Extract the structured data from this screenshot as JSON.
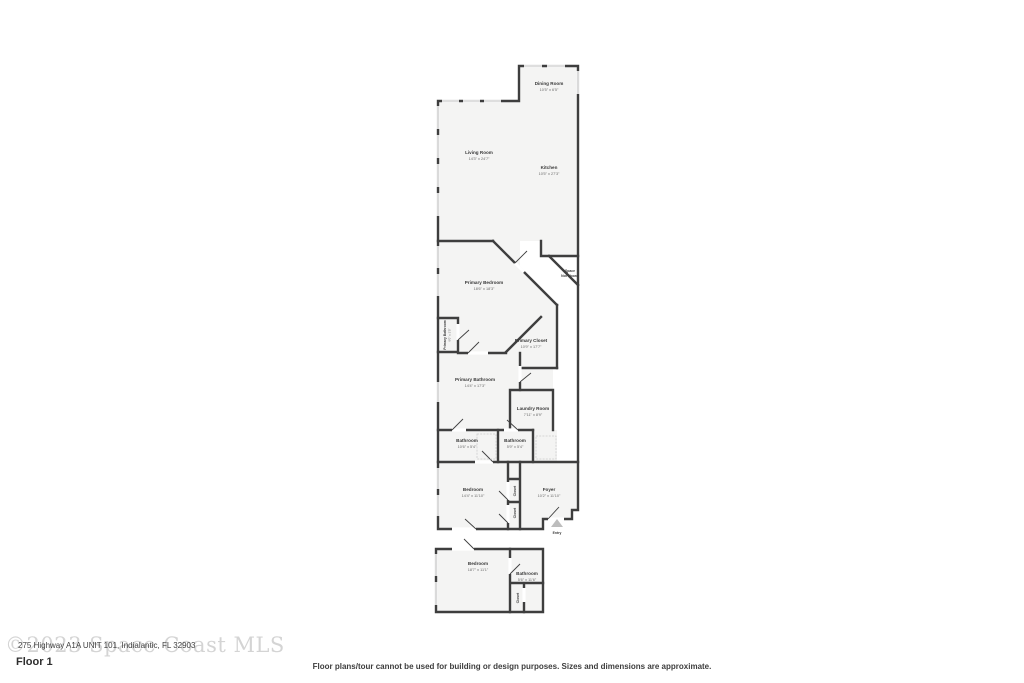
{
  "floor": {
    "label": "Floor 1"
  },
  "watermark": "©2023 Space Coast MLS",
  "address": "275 Highway A1A UNIT 101, Indialantic, FL 32903",
  "disclaimer": "Floor plans/tour cannot be used for building or design purposes. Sizes and dimensions are approximate.",
  "rooms": {
    "dining": {
      "name": "Dining Room",
      "dims": "10'5\" x 6'5\""
    },
    "living": {
      "name": "Living Room",
      "dims": "14'3\" x 24'7\""
    },
    "kitchen": {
      "name": "Kitchen",
      "dims": "10'5\" x 27'3\""
    },
    "space_not_shown": {
      "line1": "Space",
      "line2": "Not Shown"
    },
    "primary_bedroom": {
      "name": "Primary Bedroom",
      "dims": "18'6\" x 18'3\""
    },
    "primary_bath_wc": {
      "name": "Primary Bathroom",
      "dims": "6'0\" x 3'5\""
    },
    "primary_closet": {
      "name": "Primary Closet",
      "dims": "10'9\" x 17'7\""
    },
    "primary_bathroom": {
      "name": "Primary Bathroom",
      "dims": "14'4\" x 17'3\""
    },
    "laundry": {
      "name": "Laundry Room",
      "dims": "7'11\" x 8'9\""
    },
    "bathroom_1": {
      "name": "Bathroom",
      "dims": "10'6\" x 5'4\""
    },
    "bathroom_2": {
      "name": "Bathroom",
      "dims": "5'9\" x 5'4\""
    },
    "bedroom_1": {
      "name": "Bedroom",
      "dims": "14'4\" x 11'10\""
    },
    "foyer": {
      "name": "Foyer",
      "dims": "10'2\" x 11'10\""
    },
    "entry": {
      "name": "Entry"
    },
    "bedroom_2": {
      "name": "Bedroom",
      "dims": "18'7\" x 11'1\""
    },
    "bathroom_3": {
      "name": "Bathroom",
      "dims": "5'6\" x 11'6\""
    },
    "closet": {
      "name": "Closet"
    }
  },
  "colors": {
    "wall": "#3e3e3e",
    "room_fill": "#f4f4f3",
    "window": "#bcbcbc",
    "entry_marker": "#bdbdbd",
    "watermark": "#d4d4d4"
  }
}
